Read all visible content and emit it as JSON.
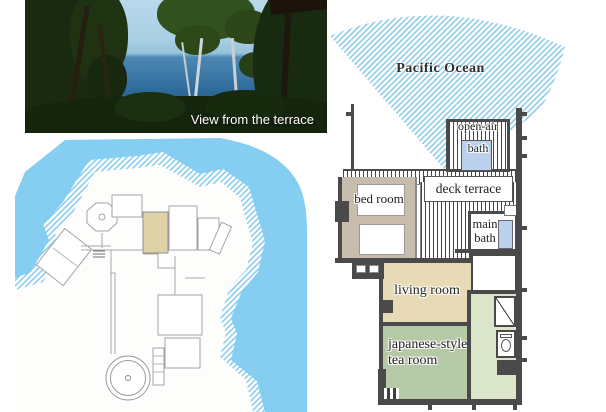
{
  "photo": {
    "caption": "View from the terrace"
  },
  "floor_plan": {
    "ocean_label": "Pacific Ocean",
    "rooms": {
      "open_air_bath": {
        "line1": "open-air",
        "line2": "bath"
      },
      "deck_terrace": {
        "label": "deck terrace"
      },
      "bed_room": {
        "label": "bed room"
      },
      "main_bath": {
        "line1": "main",
        "line2": "bath"
      },
      "living_room": {
        "label": "living room"
      },
      "tea_room": {
        "line1": "japanese-style",
        "line2": "tea room"
      }
    }
  },
  "colors": {
    "water": "#85cdf1",
    "shore-hatch": "#7ec8ef",
    "ocean-hatch": "#8ecbe9",
    "wall": "#4a4a4a",
    "tan-room": "#e7dab6",
    "bedroom-floor": "#c7bcae",
    "tea-green": "#b6c9a7",
    "corridor-green": "#dae5ca",
    "bath-blue": "#bad0ed",
    "site-highlight": "#e0d2a8",
    "outline-gray": "#a3a3a3"
  }
}
